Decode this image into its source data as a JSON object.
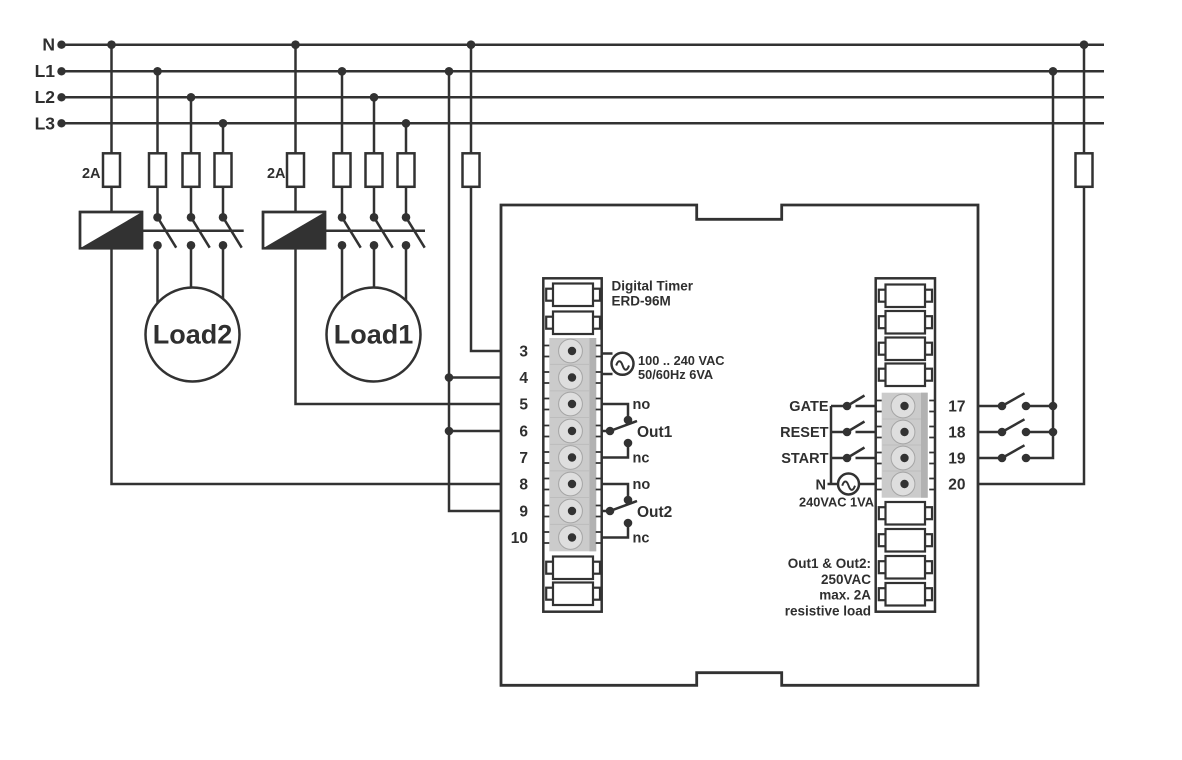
{
  "colors": {
    "line": "#323232",
    "text": "#2f2f2f",
    "conn": "#cbcbcb",
    "conn-shadow": "#b2b2b2",
    "bulge": "#dedede",
    "bg": "#ffffff"
  },
  "rails": {
    "labels": [
      "N",
      "L1",
      "L2",
      "L3"
    ]
  },
  "branches": {
    "load2": {
      "fuse_label": "2A",
      "load_label": "Load2"
    },
    "load1": {
      "fuse_label": "2A",
      "load_label": "Load1"
    }
  },
  "device": {
    "title1": "Digital Timer",
    "title2": "ERD-96M",
    "supply1": "100 .. 240 VAC",
    "supply2": "50/60Hz 6VA",
    "out1": {
      "no": "no",
      "label": "Out1",
      "nc": "nc"
    },
    "out2": {
      "no": "no",
      "label": "Out2",
      "nc": "nc"
    },
    "left_terminals": [
      "3",
      "4",
      "5",
      "6",
      "7",
      "8",
      "9",
      "10"
    ],
    "right_terminals": [
      "17",
      "18",
      "19",
      "20"
    ],
    "inputs": [
      "GATE",
      "RESET",
      "START"
    ],
    "neutral": "N",
    "control_supply": "240VAC 1VA",
    "note": [
      "Out1 & Out2:",
      "250VAC",
      "max. 2A",
      "resistive load"
    ]
  }
}
